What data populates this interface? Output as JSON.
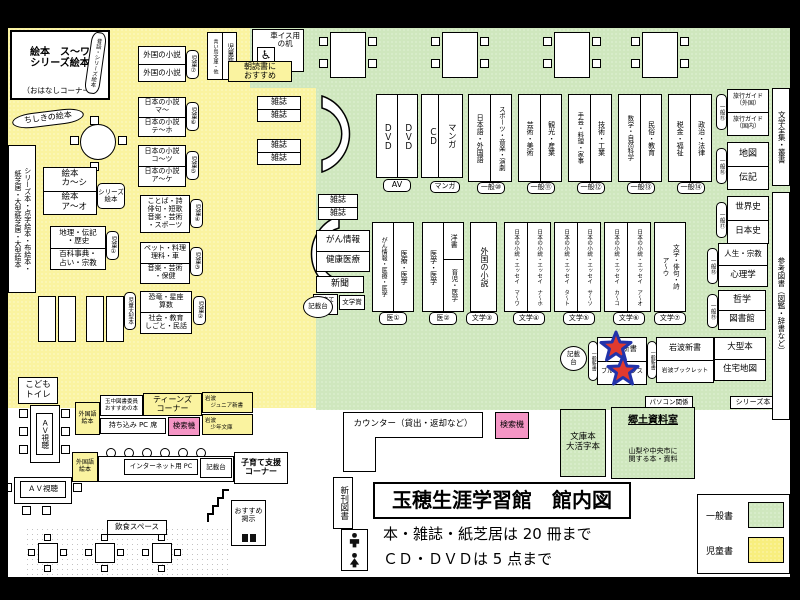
{
  "colors": {
    "children_area": "#FAF3A0",
    "general_area": "#CFE7BE",
    "search_pink": "#F595C5",
    "star_red": "#E03A2F",
    "star_outline": "#2233AA"
  },
  "kids": {
    "room_title": "絵本　ス～ワ\nシリーズ絵本",
    "room_sub": "（おはなしコーナー）",
    "arc_shelf": "昔話・シリーズ絵本",
    "chishiki": "ちしきの絵本",
    "tall_shelf": "シリーズ本・点字絵本・布絵本・\n紙芝居・大型紙芝居・大型絵本",
    "ehon_top": "絵本\n　カ～シ",
    "ehon_bottom": "絵本\n　ア～オ",
    "ehon_tag": "シリーズ\n絵本",
    "chiri_top": "地理・伝記\n・歴史",
    "chiri_bottom": "百科事典・\n占い・宗教",
    "chiri_tag": "児童①",
    "foreign_top": "外国の小説",
    "foreign_bottom": "外国の小説",
    "foreign_tag": "児童⑦",
    "nihon_ma_top": "日本の小説\nマ～",
    "nihon_ma_bottom": "日本の小説\nテ～ホ",
    "nihon_ma_tag": "児童⑥",
    "nihon_ko_top": "日本の小説\nコ～ツ",
    "nihon_ko_bottom": "日本の小説\nア～ケ",
    "nihon_ko_tag": "児童⑤",
    "kotoba": "ことば・詩\n俳句・短歌\n音楽・芸術\n・スポーツ",
    "kotoba_tag": "児童④",
    "pet_top": "ペット・料理\n理科・車",
    "pet_bottom": "音楽・芸術\n・保健",
    "pet_tag": "児童③",
    "kyoryu_top": "恐竜・星座\n算数",
    "kyoryu_bottom": "社会・教育\nしごと・民話",
    "kyoryu_tag": "児童②",
    "ogata_tag": "児童大型本",
    "zasshi": "雑誌",
    "aoitori": "青い鳥文庫・他",
    "jido_shinsho": "児童新書",
    "asadoku": "朝読書に\nおすすめ",
    "kodomo_toilet": "こども\nトイレ"
  },
  "media": {
    "dvd": "ＤＶＤ",
    "cd": "ＣＤ",
    "manga": "マンガ",
    "av_tag": "AV",
    "manga_tag": "マンガ"
  },
  "general": {
    "wheelchair_desk": "車イス用\nの机",
    "wheelchair_icon": "♿",
    "zasshi": "雑誌",
    "pairs": [
      {
        "left": "日本語・外国語",
        "right": "スポーツ・音楽・演劇",
        "tag": "一般⑩"
      },
      {
        "left": "芸術・美術",
        "right": "観光・産業",
        "tag": "一般⑪"
      },
      {
        "left": "手芸・料理・家事",
        "right": "技術・工業",
        "tag": "一般⑫"
      },
      {
        "left": "数学・自然科学",
        "right": "民俗・教育",
        "tag": "一般⑬"
      },
      {
        "left": "税金・福祉",
        "right": "政治・法律",
        "tag": "一般⑭"
      }
    ],
    "gan": "がん情報",
    "kenko": "健康医療",
    "shinbun": "新聞",
    "kosodate_ouen": "子育て\n応援",
    "bungakusho": "文学賞",
    "kisaidai": "記載台",
    "kisaidai2": "記載\n台",
    "med1_left": "がん情報・医療・医学",
    "med1_right": "医療・医学",
    "med1_tag": "医①",
    "med2_left": "医学・医学",
    "med2_right_top": "洋書",
    "med2_right_bottom": "育児・医学",
    "med2_tag": "医②",
    "foreign_novel": "外国の小説",
    "foreign_tag": "文学③",
    "jnovels": [
      "日本の小説・エッセイ　マ～ワ",
      "日本の小説・エッセイ　ナ～ホ",
      "日本の小説・エッセイ　タ～ト",
      "日本の小説・エッセイ　サ～ソ",
      "日本の小説・エッセイ　カ～コ",
      "日本の小説・エッセイ　ア～オ"
    ],
    "jtags": [
      "文学④",
      "文学⑤",
      "文学⑥"
    ],
    "bungaku_col": "文学・俳句・詩\nア～ウ",
    "bungaku_tag": "文学⑦",
    "shinsho_tag": "一般新書",
    "chuko": "中公新書",
    "bluebacks": "ブルーバックス",
    "iwanami_shinsho": "岩波新書",
    "iwanami_booklet": "岩波ブックレット",
    "pasokon": "パソコン関係",
    "series_bon": "シリーズ本"
  },
  "right_side": {
    "shelves": [
      {
        "top": "旅行ガイド\n（外国）",
        "bottom": "旅行ガイド\n（国内）",
        "tag": "一般⑮"
      },
      {
        "top": "地図",
        "bottom": "伝記",
        "tag": "一般⑯"
      },
      {
        "top": "世界史",
        "bottom": "日本史",
        "tag": "一般⑰"
      },
      {
        "top": "人生・宗教",
        "bottom": "心理学",
        "tag": "一般⑱"
      },
      {
        "top": "哲学",
        "bottom": "図書館",
        "tag": "一般⑲"
      }
    ],
    "ogata_top": "大型本",
    "ogata_bottom": "住宅地図",
    "zenshu": "文学全集・叢書",
    "sanko": "参考図書（図鑑・辞書など）"
  },
  "service": {
    "counter": "カウンター（貸出・返却など）",
    "kensaku": "検索機",
    "bunko": "文庫本\n大活字本",
    "kyodo_title": "郷土資料室",
    "kyodo_sub": "山梨や中央市に\n関する本・資料",
    "shinkan": "新刊図書"
  },
  "teens": {
    "gaikokugo_ehon": "外国語\n絵本",
    "tamachu": "玉中図書委員\nおすすめの本",
    "teens_corner": "ティーンズ\nコーナー",
    "mochikomi": "持ち込み PC 席",
    "kensaku": "検索機",
    "iwanami_jr": "岩波\n　ジュニア新書",
    "iwanami_shonen": "岩波\n　少年文庫"
  },
  "entrance": {
    "internet_pc": "インターネット用 PC",
    "kisaidai": "記載台",
    "kosodate_corner": "子育て支援\nコーナー",
    "osusume": "おすすめ\n掲示",
    "av_label": "ＡＶ視聴",
    "inshoku": "飲食スペース"
  },
  "footer": {
    "title": "玉穂生涯学習館　館内図",
    "note1": "本・雑誌・紙芝居は 20 冊まで",
    "note2": "ＣＤ・ＤＶＤは 5 点まで",
    "legend_general": "一般書",
    "legend_children": "児童書"
  }
}
